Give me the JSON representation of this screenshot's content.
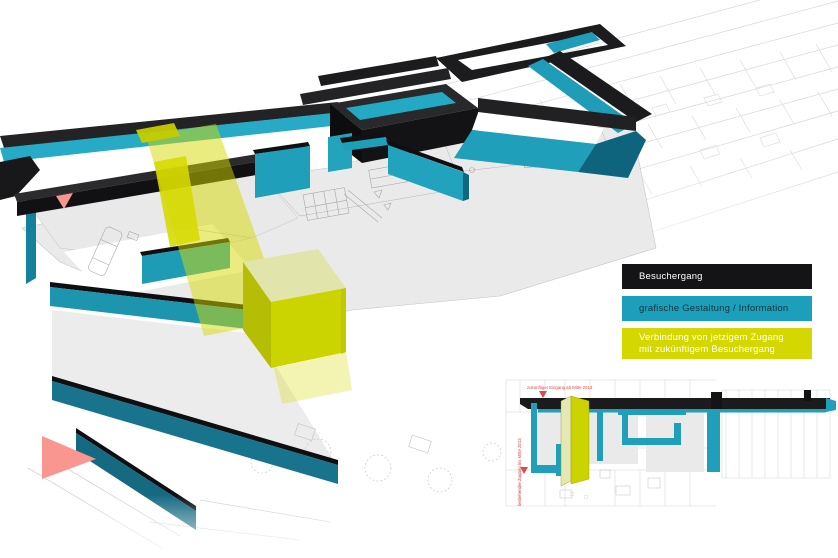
{
  "legend": {
    "items": [
      {
        "label": "Besuchergang",
        "color": "#141416",
        "text_color": "#ffffff"
      },
      {
        "label": "grafische Gestaltung / Information",
        "color": "#1b9fba",
        "text_color": "#17343c"
      },
      {
        "label_line1": "Verbindung von jetzigem Zugang",
        "label_line2": "mit zukünftigem Besuchergang",
        "color": "#d5d800",
        "text_color": "#ffffff"
      }
    ]
  },
  "inset": {
    "annotation_top": "zukünftiger Eingang ab Mitte 2013",
    "annotation_left": "bestehender Zugang bis Mitte 2013",
    "annotation_color": "#e0484e"
  },
  "colors": {
    "besuchergang_black": "#1b1b1d",
    "information_teal": "#1f9fba",
    "verbindung_yellow": "#d5d800",
    "verbindung_block_front": "#ccd400",
    "verbindung_block_top": "#e2e5ab",
    "floor_plan_gray": "#ececec",
    "plan_line_gray": "#c8c8c8",
    "marker_pink": "#f8968f",
    "annotation_red": "#e0484e",
    "background": "#ffffff"
  }
}
